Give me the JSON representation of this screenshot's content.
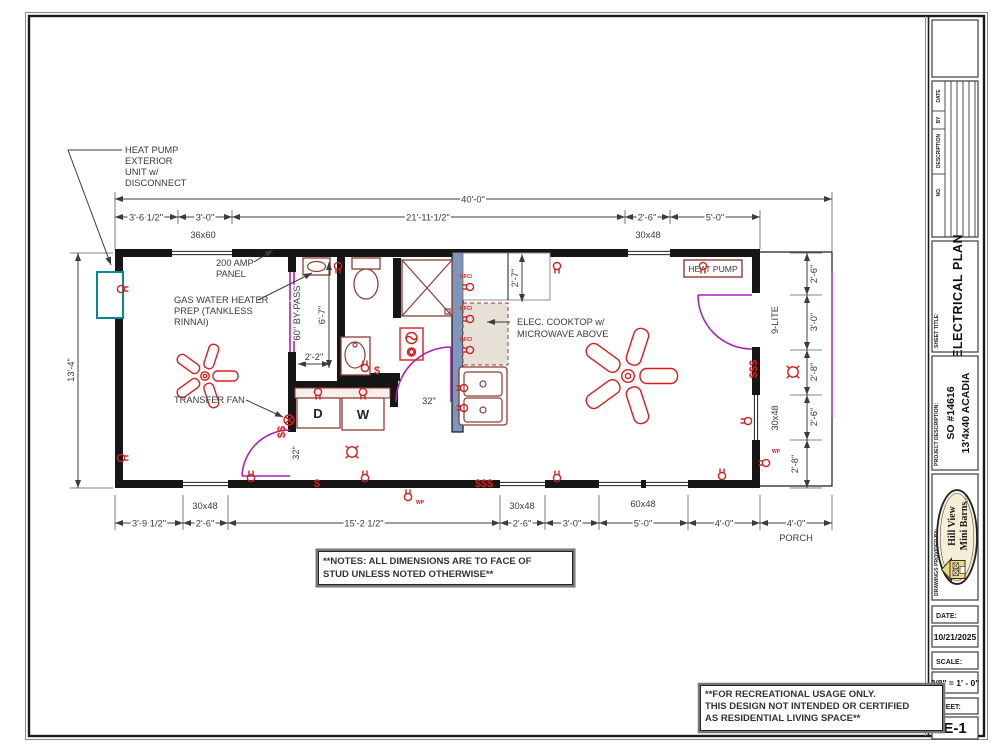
{
  "annotations": {
    "heat_pump_ext": [
      "HEAT PUMP",
      "EXTERIOR",
      "UNIT w/",
      "DISCONNECT"
    ],
    "amp_panel": [
      "200 AMP",
      "PANEL"
    ],
    "gas_wh": [
      "GAS WATER HEATER",
      "PREP (TANKLESS",
      "RINNAI)"
    ],
    "transfer_fan": "TRANSFER FAN",
    "cooktop": [
      "ELEC. COOKTOP w/",
      "MICROWAVE ABOVE"
    ],
    "heat_pump_unit": "HEAT PUMP"
  },
  "dims": {
    "overall": "40'-0\"",
    "top": [
      "3'-6 1/2\"",
      "3'-0\"",
      "21'-11 1/2\"",
      "2'-6\"",
      "5'-0\""
    ],
    "top_windows": [
      "36x60",
      "30x48"
    ],
    "left_height": "13'-4\"",
    "right": [
      "2'-6\"",
      "3'-0\"",
      "2'-8\"",
      "2'-6\"",
      "2'-8\""
    ],
    "bottom": [
      "3'-9 1/2\"",
      "2'-6\"",
      "15'-2 1/2\"",
      "2'-6\"",
      "3'-0\"",
      "5'-0\"",
      "4'-0\"",
      "4'-0\""
    ],
    "bottom_windows": [
      "30x48",
      "30x48",
      "60x48"
    ],
    "porch": "PORCH",
    "hall_width": "2'-2\"",
    "utility_len": "6'-7\"",
    "counter": "2'-7\"",
    "door_hall": "32\"",
    "door_left": "32\"",
    "bypass": "60\" BY-PASS",
    "nine_lite": "9-LITE",
    "right_window": "30x48"
  },
  "rooms": {
    "dryer": "D",
    "washer": "W"
  },
  "symbols": {
    "gfci": "GFCI",
    "wp": "WP",
    "switch": "$",
    "switch2": "$$",
    "switch3": "$$$"
  },
  "notes": [
    "**NOTES:  ALL DIMENSIONS ARE TO FACE OF",
    "STUD UNLESS NOTED OTHERWISE**"
  ],
  "disclaimer": [
    "**FOR RECREATIONAL USAGE ONLY.",
    "THIS DESIGN NOT INTENDED OR CERTIFIED",
    "AS RESIDENTIAL LIVING SPACE**"
  ],
  "titleblock": {
    "rev_headers": [
      "DATE",
      "BY",
      "DESCRIPTION",
      "NO."
    ],
    "sheet_title_label": "SHEET TITLE:",
    "sheet_title": "ELECTRICAL PLAN",
    "project_label": "PROJECT DESCRIPTION:",
    "project_so": "SO #14616",
    "project_model": "13'4x40 ACADIA",
    "provided_label": "DRAWINGS PROVIDED BY:",
    "logo": [
      "Hill View",
      "Mini Barns"
    ],
    "logo_llc": "LLC",
    "date_label": "DATE:",
    "date_value": "10/21/2025",
    "scale_label": "SCALE:",
    "scale_value": "3/8\" = 1' - 0\"",
    "sheet_label": "SHEET:",
    "sheet_value": "E-1"
  },
  "colors": {
    "electric": "#d41f1f",
    "door_swing": "#a821b8",
    "wet_wall": "#7e96bb",
    "hvac_teal": "#00898f",
    "fixture": "#8e3b34"
  }
}
